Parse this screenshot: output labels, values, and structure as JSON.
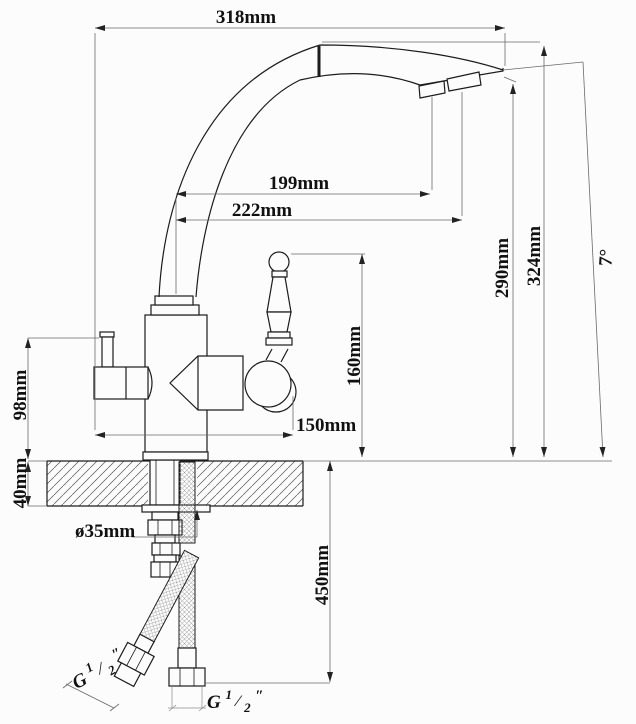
{
  "drawing": {
    "title_semantic": "kitchen-faucet-installation-dimension-drawing",
    "dimensions": {
      "spout_overall_width": "318mm",
      "spout_reach_inner": "199mm",
      "spout_reach_outer": "222mm",
      "outlet_height": "290mm",
      "total_height": "324mm",
      "spout_tilt_angle": "7°",
      "handle_top_height": "160mm",
      "side_handle_height": "98mm",
      "base_span": "150mm",
      "counter_thickness": "40mm",
      "mount_hole_diameter": "ø35mm",
      "hose_length": "450mm"
    },
    "thread_left": {
      "g": "G",
      "num": "1",
      "slash": "⁄",
      "den": "2",
      "unit": "″"
    },
    "thread_bottom": {
      "g": "G",
      "num": "1",
      "slash": "⁄",
      "den": "2",
      "unit": "″"
    }
  },
  "colors": {
    "object_line": "#1c1c1c",
    "dimension_line": "#6a6a6a",
    "text": "#111111",
    "background": "#fcfcfc"
  }
}
